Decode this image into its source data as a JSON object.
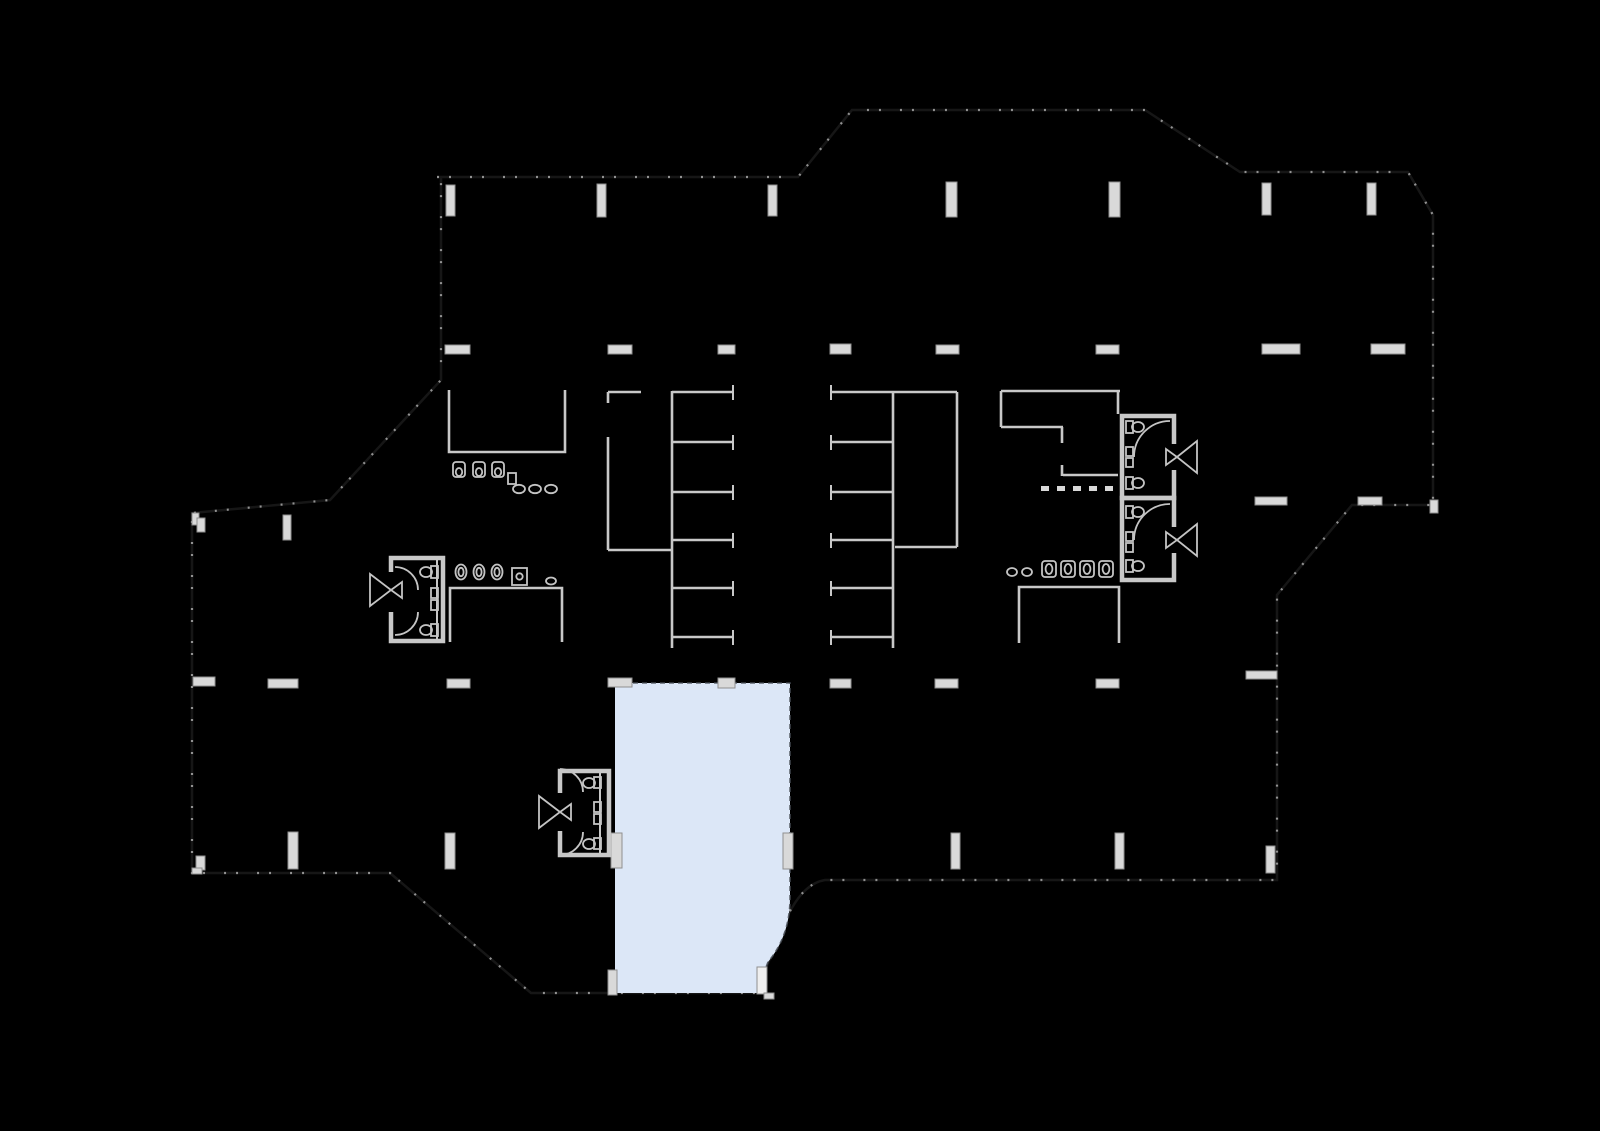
{
  "palette": {
    "background": "#000000",
    "wall": "#c8c8c8",
    "wall_dim": "#161616",
    "window_tick": "#a8a8a8",
    "sill_fill": "#d9d9d9",
    "sill_stroke": "#8f8f8f",
    "fixture": "#c4c4c4",
    "unit_fill": "#dce7f7",
    "unit_edge": "#4a5058",
    "door_leaf": "#efefef"
  },
  "plan": {
    "kind": "architectural-floor-plan",
    "highlighted_unit": {
      "id": "highlighted-unit",
      "state": "highlighted",
      "fill": "#dce7f7",
      "location": "bottom-center"
    },
    "elements": [
      "building-outline",
      "north-bay",
      "window-piers-north",
      "wall-stub-rows",
      "south-window-sills",
      "stair-core-west",
      "stair-core-east",
      "room-north-center",
      "room-center",
      "room-northeast-cluster",
      "room-east-center",
      "restroom-west",
      "restroom-east",
      "restroom-south",
      "sink-rows",
      "door-swing-symbols",
      "highlighted-unit"
    ]
  }
}
